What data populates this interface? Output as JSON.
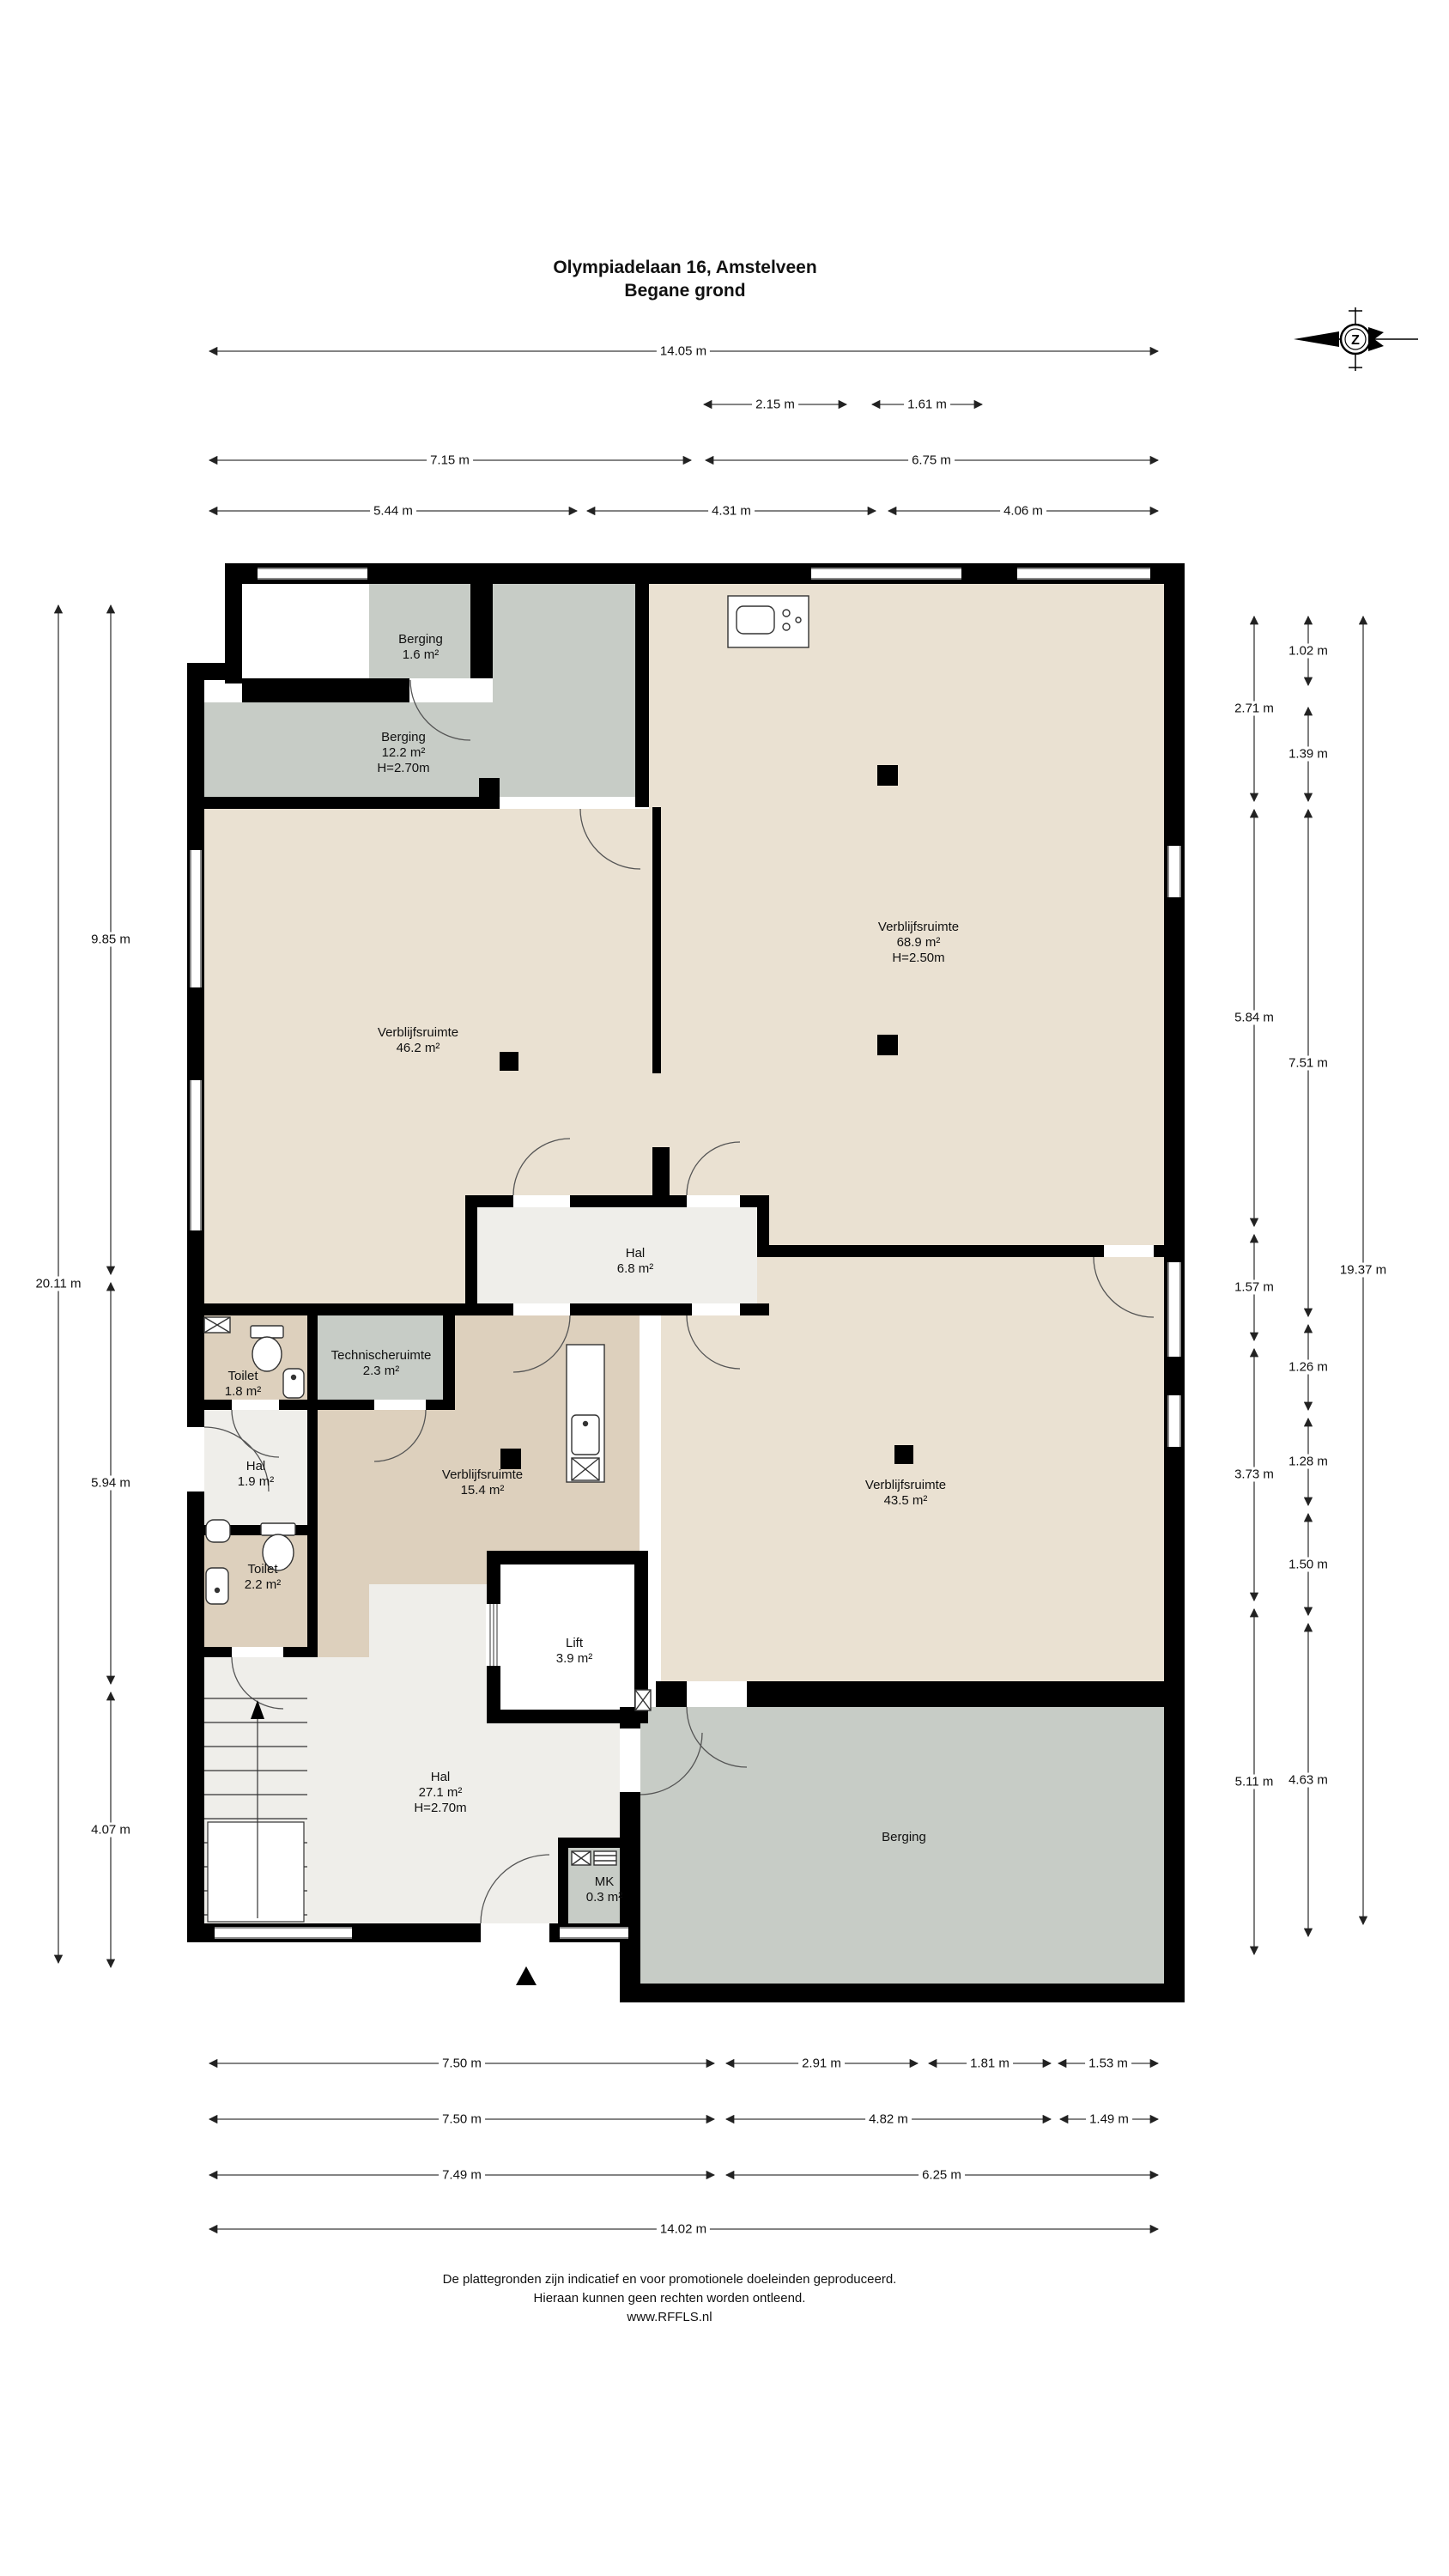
{
  "title": {
    "line1": "Olympiadelaan 16, Amstelveen",
    "line2": "Begane grond"
  },
  "compass": {
    "letter": "Z"
  },
  "rooms": {
    "berging16": {
      "name": "Berging",
      "area": "1.6 m²"
    },
    "berging122": {
      "name": "Berging",
      "area": "12.2 m²",
      "height": "H=2.70m"
    },
    "verblijf689": {
      "name": "Verblijfsruimte",
      "area": "68.9 m²",
      "height": "H=2.50m"
    },
    "verblijf462": {
      "name": "Verblijfsruimte",
      "area": "46.2 m²"
    },
    "hal68": {
      "name": "Hal",
      "area": "6.8 m²"
    },
    "toilet18": {
      "name": "Toilet",
      "area": "1.8 m²"
    },
    "technische23": {
      "name": "Technischeruimte",
      "area": "2.3 m²"
    },
    "hal19": {
      "name": "Hal",
      "area": "1.9 m²"
    },
    "verblijf154": {
      "name": "Verblijfsruimte",
      "area": "15.4 m²"
    },
    "verblijf435": {
      "name": "Verblijfsruimte",
      "area": "43.5 m²"
    },
    "toilet22": {
      "name": "Toilet",
      "area": "2.2 m²"
    },
    "lift39": {
      "name": "Lift",
      "area": "3.9 m²"
    },
    "hal271": {
      "name": "Hal",
      "area": "27.1 m²",
      "height": "H=2.70m"
    },
    "mk03": {
      "name": "MK",
      "area": "0.3 m²"
    },
    "bergingBottom": {
      "name": "Berging"
    }
  },
  "dimensions": {
    "top": [
      "14.05 m",
      "2.15 m",
      "1.61 m",
      "7.15 m",
      "6.75 m",
      "5.44 m",
      "4.31 m",
      "4.06 m"
    ],
    "bottom": [
      "7.50 m",
      "2.91 m",
      "1.81 m",
      "1.53 m",
      "7.50 m",
      "4.82 m",
      "1.49 m",
      "7.49 m",
      "6.25 m",
      "14.02 m"
    ],
    "left": [
      "9.85 m",
      "5.94 m",
      "4.07 m",
      "20.11 m"
    ],
    "right": [
      "2.71 m",
      "5.84 m",
      "1.57 m",
      "3.73 m",
      "5.11 m",
      "1.02 m",
      "1.39 m",
      "7.51 m",
      "1.26 m",
      "1.28 m",
      "1.50 m",
      "4.63 m",
      "19.37 m"
    ]
  },
  "footer": {
    "line1": "De plattegronden zijn indicatief en voor promotionele doeleinden geproduceerd.",
    "line2": "Hieraan kunnen geen rechten worden ontleend.",
    "line3": "www.RFFLS.nl"
  },
  "colors": {
    "wall": "#000000",
    "room_beige": "#eae1d2",
    "room_tan": "#ddd0bd",
    "room_gray": "#c7ccc6",
    "room_light": "#efeeea",
    "dim_line": "#3a3a3a"
  }
}
